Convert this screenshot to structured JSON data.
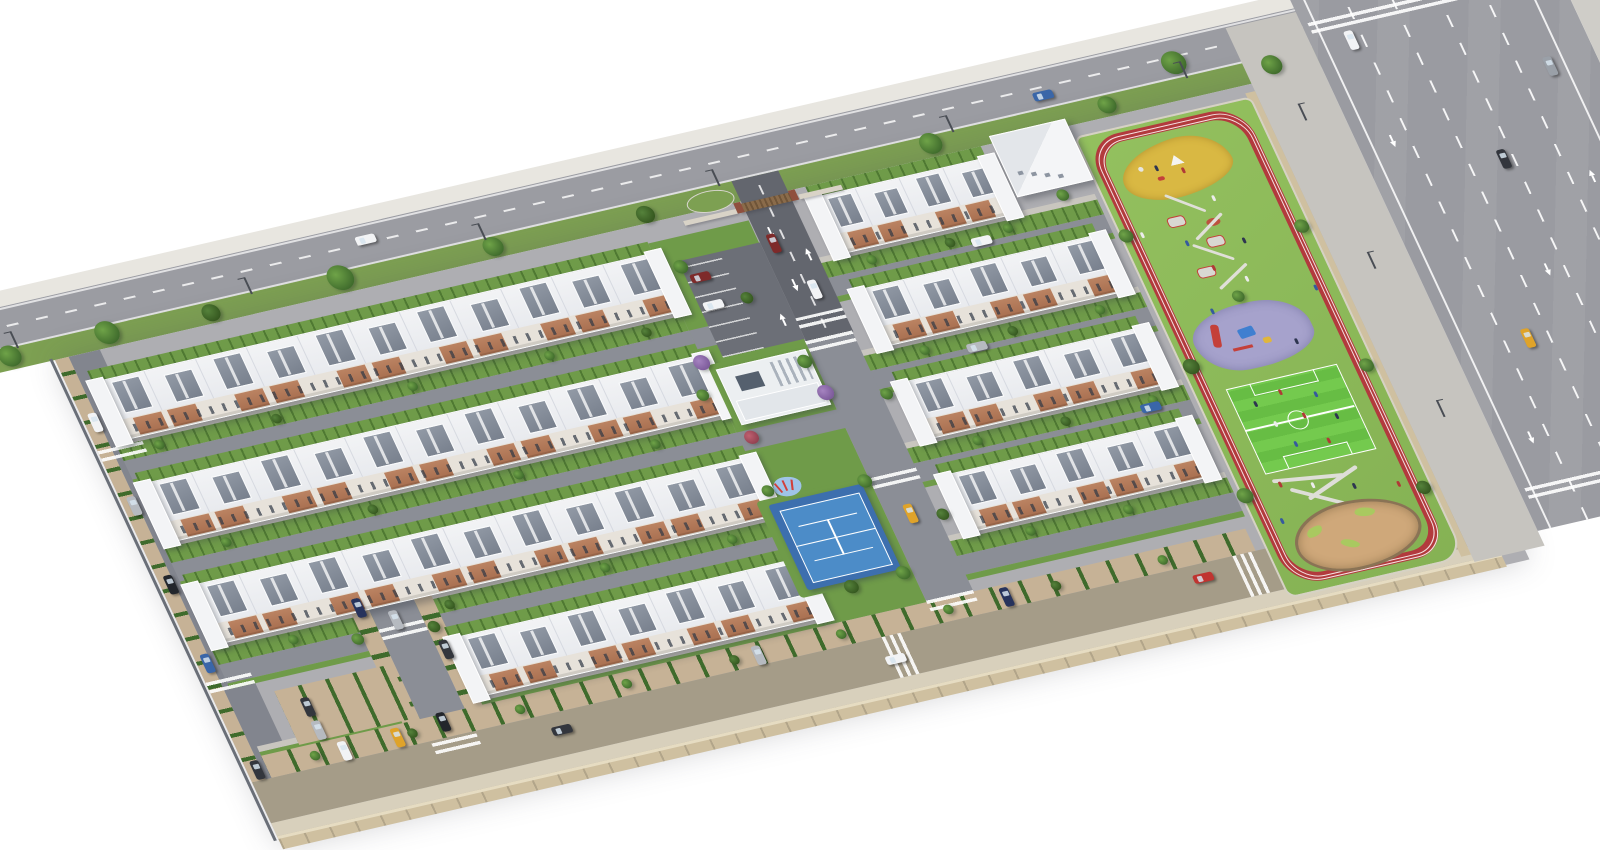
{
  "meta": {
    "title": "Aerial 3D rendering of a residential apartment complex master plan",
    "description": "Bird's-eye view of a gated housing development: long rows of white apartment blocks with terracotta brick facades and grey shed roofs, internal tree-lined streets with parked cars, entrance gate with visitor parking, central clubhouse, blue tennis court, and a linear park with red running track, sand playground, play structures, toddler playground, mini soccer field and sand garden, bordered by a multi-lane avenue on the right and an avenue along the top."
  },
  "palette": {
    "background": "#ffffff",
    "sitePaving": "#aeaeb2",
    "roadTop": "#9b9ca2",
    "roadInternal": "#8b8e96",
    "roadEntrance": "#63666e",
    "roadLeft": "#82858e",
    "roadBottom": "#a59c88",
    "sidewalk": "#e8e6e0",
    "sidewalkWarm": "#d8d0bc",
    "verge": "#7da052",
    "garden": "#6f9b49",
    "hedge": "#3f6b2c",
    "lawn": "#85b254",
    "lawnLight": "#93c05e",
    "parkingTan": "#c6b296",
    "wall": "#cfc0a0",
    "fence": "#6a6f78",
    "white": "#f1f2f4",
    "whiteShade": "#dcdee3",
    "roof": "#929aa6",
    "roofDark": "#78808d",
    "facade": "#e7e2da",
    "brick": "#bb8362",
    "brickDark": "#a86f50",
    "window": "#2f3845",
    "trackRed": "#b23a3d",
    "laneWhite": "rgba(255,255,255,0.85)",
    "soccer": "#74ca4e",
    "soccerDark": "#67bd44",
    "tennis": "#4c8cc8",
    "tennisApron": "#3d6fae",
    "sand": "#d9b843",
    "sandTan": "#cfa87a",
    "sandRim": "#8a7355",
    "mat": "#a6a2cc",
    "matBlue": "#9fc4e8",
    "clubRoof": "#aab2bc",
    "pole": "#494d54",
    "car": {
      "white": "#f2f3f5",
      "silver": "#b6bac0",
      "grey": "#9aa0a8",
      "black": "#23262c",
      "dark": "#33363d",
      "red": "#c03430",
      "darkred": "#7e2a2a",
      "blue": "#3a66a8",
      "navy": "#27335c",
      "yellow": "#dfa32a"
    },
    "tree": {
      "g": [
        "#6fa348",
        "#3f6b2c"
      ],
      "d": [
        "#55823b",
        "#35571f"
      ],
      "p": [
        "#a583c0",
        "#7c5a9a"
      ],
      "r": [
        "#c06070",
        "#904050"
      ]
    },
    "people": [
      "#2e3550",
      "#b03a36",
      "#ececec",
      "#365a9e"
    ]
  },
  "scene": {
    "site_shape": "tilted parallelogram on white background",
    "building_rows_left": 4,
    "building_rows_right": 4,
    "apartment_floors": 4,
    "amenities": [
      "entrance-gate",
      "visitor-parking",
      "clubhouse",
      "tennis-court",
      "kids-swings",
      "linear-park",
      "running-track",
      "sand-playground",
      "play-structures",
      "toddler-playground",
      "mini-soccer-field",
      "sand-garden"
    ],
    "roads": [
      "top-avenue",
      "right-multilane-highway",
      "left-perimeter-street",
      "bottom-perimeter-street",
      "internal-street-west",
      "central-street",
      "entrance-driveway"
    ],
    "vehicles_count": 33,
    "trees_approx": 60,
    "people_in_park_approx": 24
  }
}
